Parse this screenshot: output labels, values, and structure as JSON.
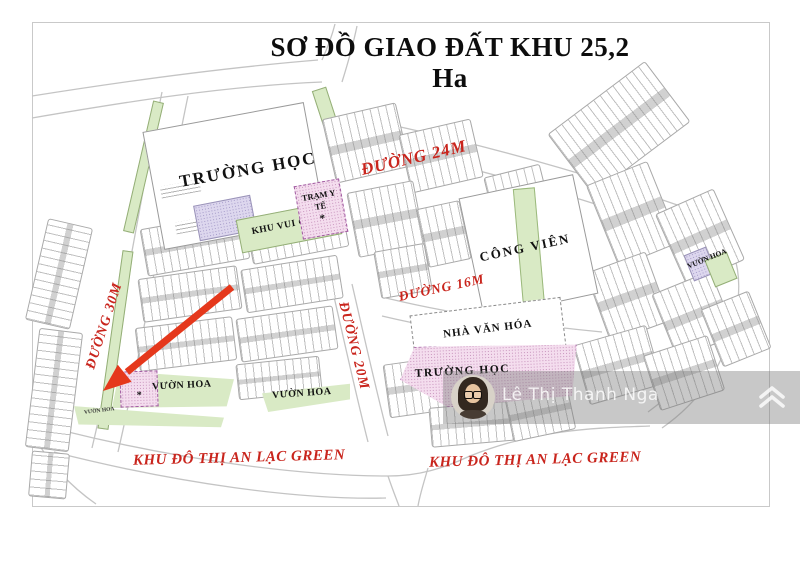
{
  "title": "SƠ ĐỒ GIAO ĐẤT KHU 25,2 Ha",
  "roads": {
    "d24": "ĐƯỜNG 24M",
    "d16": "ĐƯỜNG 16M",
    "d30": "ĐƯỜNG 30M",
    "d20": "ĐƯỜNG 20M"
  },
  "areas": {
    "school_top": "TRƯỜNG HỌC",
    "medical_station": "TRẠM Y TẾ",
    "medical_marker": "*",
    "playground": "KHU VUI CHƠI",
    "park": "CÔNG VIÊN",
    "culture_house": "NHÀ VĂN HÓA",
    "school_bottom": "TRƯỜNG HỌC",
    "flower_garden_right": "VƯỜN HOA",
    "flower_garden_left": "VƯỜN HOA",
    "flower_garden_left_marker": "*",
    "flower_garden_center": "VƯỜN HOA",
    "flower_garden_small": "VƯỜN HOA"
  },
  "district": {
    "label_left": "KHU ĐÔ THỊ AN LẠC GREEN",
    "label_right": "KHU ĐÔ THỊ AN LẠC GREEN"
  },
  "watermark": {
    "name": "Lê Thị Thanh Nga"
  },
  "colors": {
    "road_label": "#c9251d",
    "district_label": "#c9251d",
    "arrow": "#e5381c",
    "green_area": "#d9eac5",
    "pink_area": "#f4ddee",
    "purple_area": "#ddd7ee",
    "watermark_band": "rgba(125,125,125,0.42)"
  }
}
